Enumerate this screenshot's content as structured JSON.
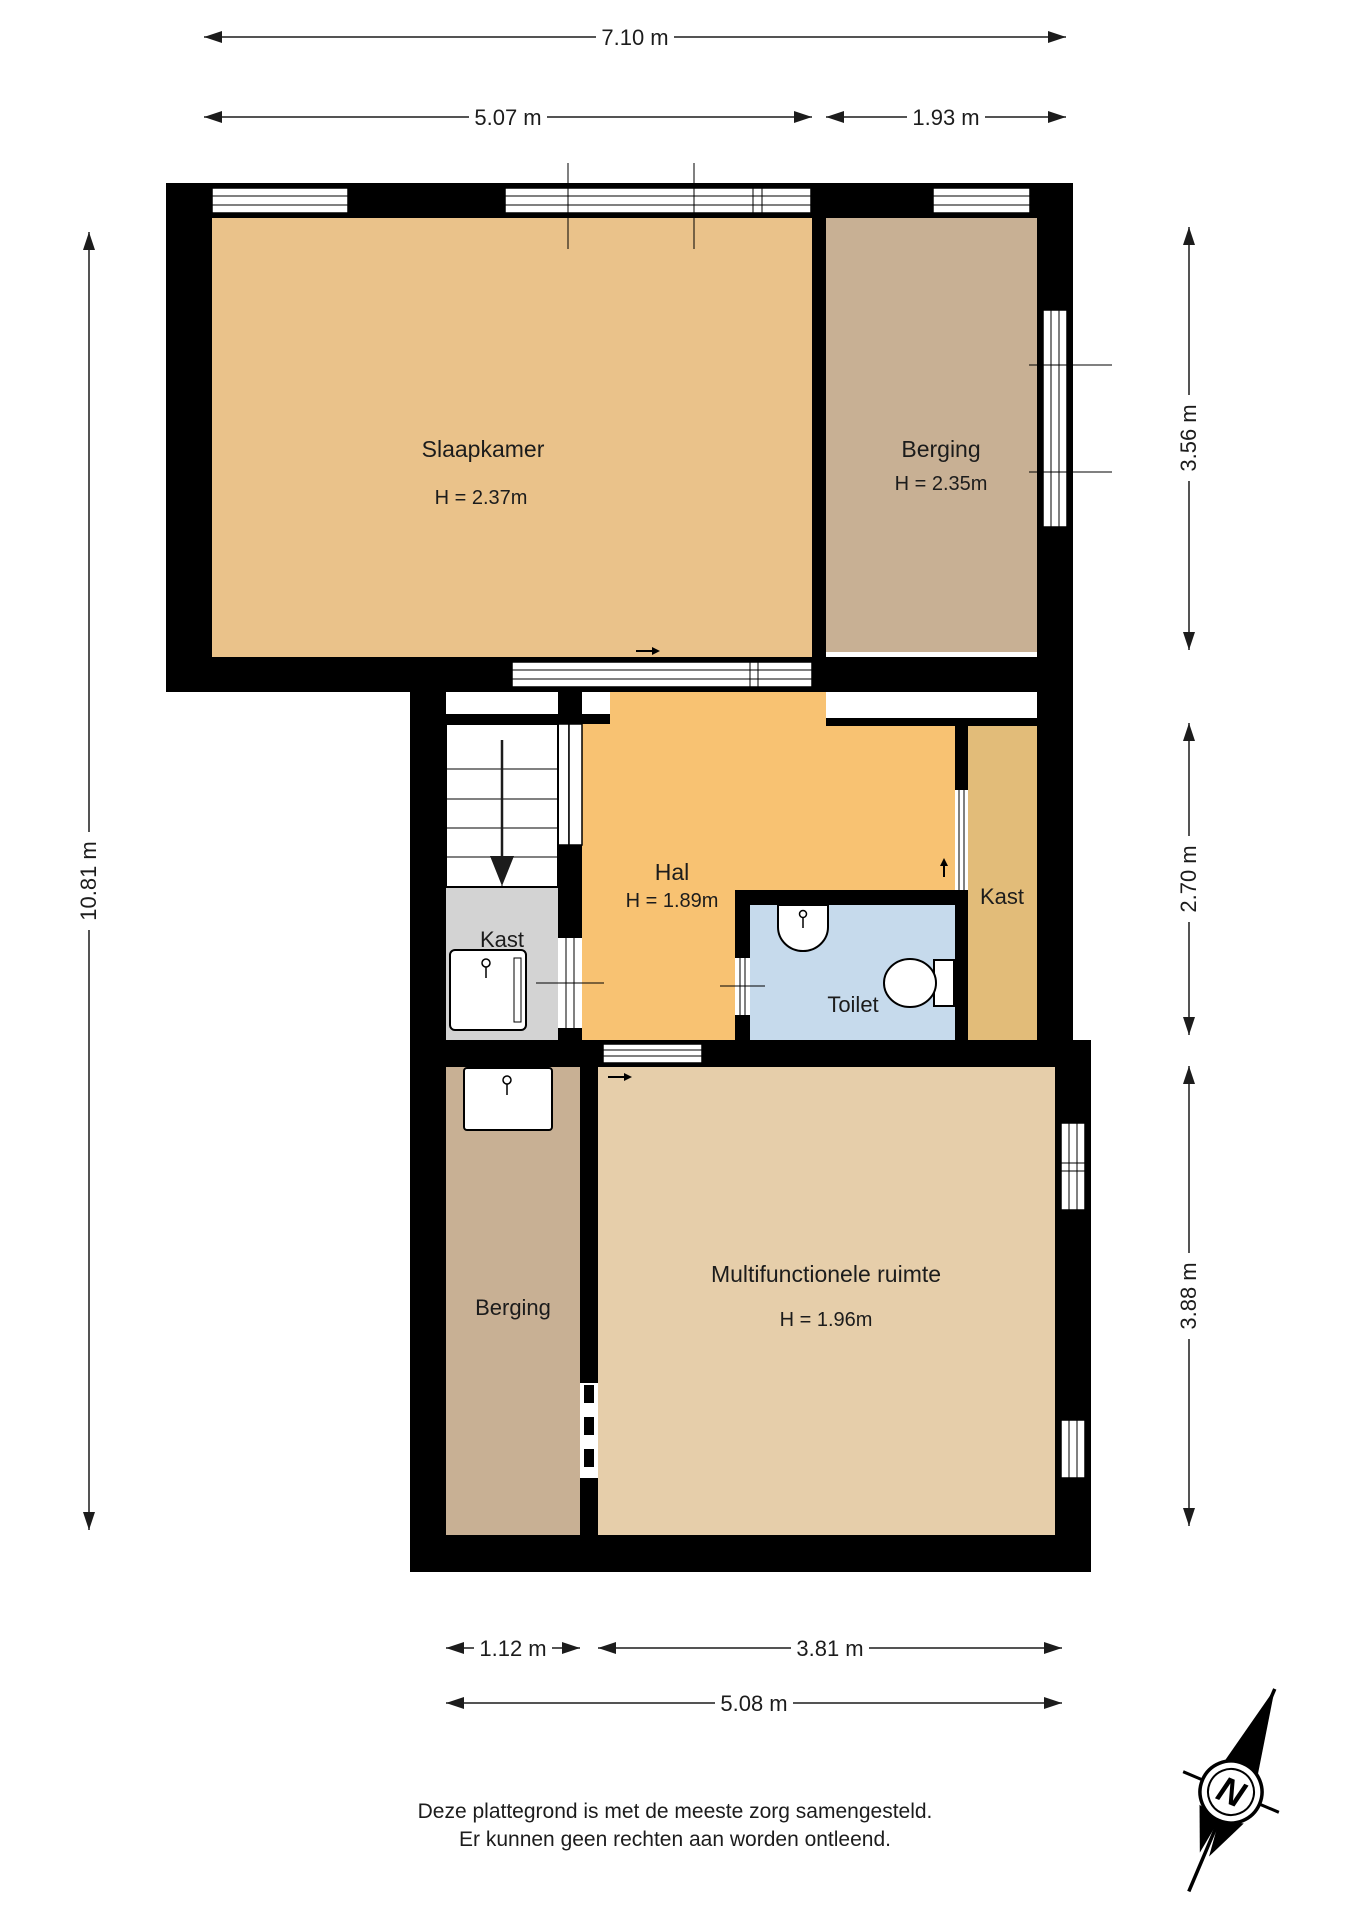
{
  "rooms": {
    "slaapkamer": {
      "name": "Slaapkamer",
      "height": "H = 2.37m"
    },
    "berging_top": {
      "name": "Berging",
      "height": "H = 2.35m"
    },
    "hal": {
      "name": "Hal",
      "height": "H = 1.89m"
    },
    "kast_left": {
      "name": "Kast"
    },
    "kast_right": {
      "name": "Kast"
    },
    "toilet": {
      "name": "Toilet"
    },
    "berging_bottom": {
      "name": "Berging"
    },
    "multifunctionele_ruimte": {
      "name": "Multifunctionele ruimte",
      "height": "H = 1.96m"
    }
  },
  "dimensions": {
    "top_total": "7.10 m",
    "top_left": "5.07 m",
    "top_right": "1.93 m",
    "left_total": "10.81 m",
    "right_top": "3.56 m",
    "right_middle": "2.70 m",
    "right_bottom": "3.88 m",
    "bottom_left": "1.12 m",
    "bottom_right": "3.81 m",
    "bottom_total": "5.08 m"
  },
  "compass": {
    "north_label": "N"
  },
  "footer": {
    "line1": "Deze plattegrond is met de meeste zorg samengesteld.",
    "line2": "Er kunnen geen rechten aan worden ontleend."
  },
  "colors": {
    "slaapkamer": "#EAC28A",
    "berging": "#C8B094",
    "hal": "#F8C272",
    "kast_right": "#E2BC79",
    "toilet": "#C6DAEC",
    "kast_left": "#D3D3D3",
    "multifunctionele_ruimte": "#E6CEAA",
    "wall": "#000000"
  }
}
